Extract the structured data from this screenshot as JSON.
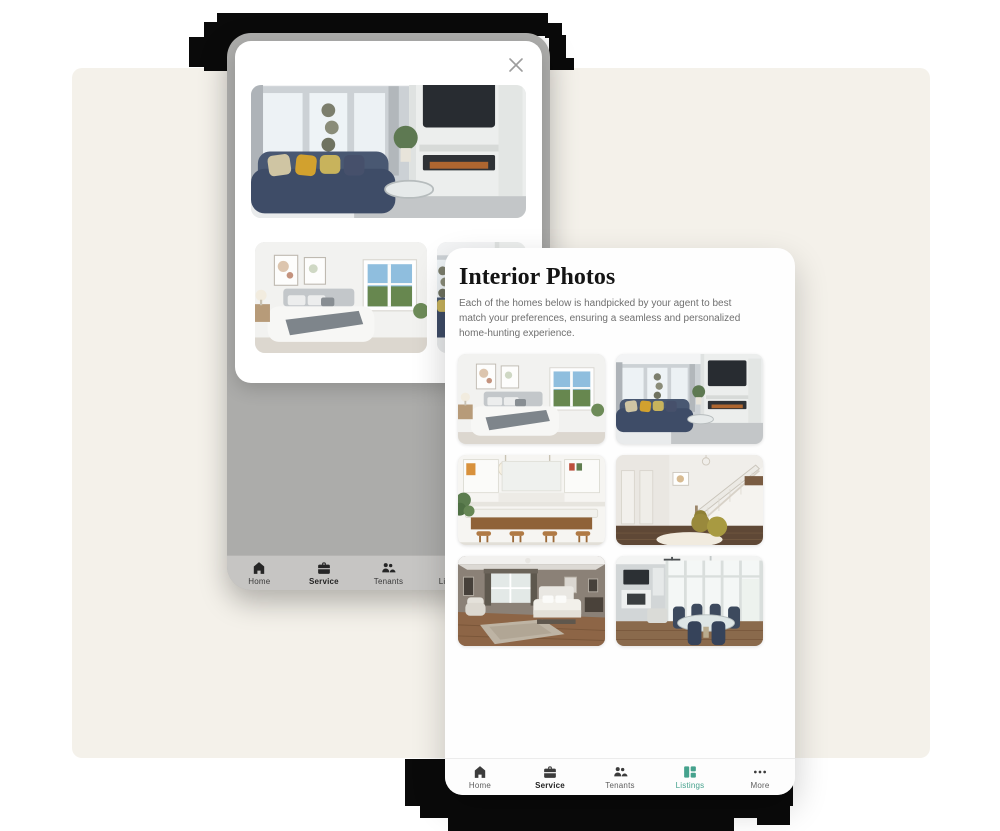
{
  "colors": {
    "canvas_bg": "#f4f1ea",
    "glitch_black": "#0a0a0a",
    "accent_teal": "#45a28d",
    "overlay_gray": "#acacaa"
  },
  "back_phone": {
    "dialog": {
      "close_label": "close",
      "photos": [
        {
          "kind": "living",
          "name": "living-room-photo-large"
        },
        {
          "kind": "bedroom",
          "name": "bedroom-photo-small"
        },
        {
          "kind": "living",
          "name": "partial-photo-small"
        }
      ]
    },
    "nav": {
      "items": [
        {
          "label": "Home",
          "icon": "home-icon",
          "emphasis": false,
          "active": false
        },
        {
          "label": "Service",
          "icon": "service-icon",
          "emphasis": true,
          "active": false
        },
        {
          "label": "Tenants",
          "icon": "tenants-icon",
          "emphasis": false,
          "active": false
        },
        {
          "label": "Listings",
          "icon": "listings-icon",
          "emphasis": false,
          "active": false
        },
        {
          "label": "More",
          "icon": "more-icon",
          "emphasis": false,
          "active": false
        }
      ]
    }
  },
  "front_phone": {
    "title": "Interior Photos",
    "description": "Each of the homes below is handpicked by your agent to best match your preferences, ensuring a seamless and personalized home-hunting experience.",
    "photos": [
      {
        "kind": "bedroom",
        "name": "bedroom-photo"
      },
      {
        "kind": "living",
        "name": "living-room-photo"
      },
      {
        "kind": "kitchen",
        "name": "kitchen-photo"
      },
      {
        "kind": "stairs",
        "name": "staircase-photo"
      },
      {
        "kind": "bedroom2",
        "name": "master-bedroom-photo"
      },
      {
        "kind": "dining",
        "name": "dining-room-photo"
      }
    ],
    "nav": {
      "items": [
        {
          "label": "Home",
          "icon": "home-icon",
          "emphasis": false,
          "active": false
        },
        {
          "label": "Service",
          "icon": "service-icon",
          "emphasis": true,
          "active": false
        },
        {
          "label": "Tenants",
          "icon": "tenants-icon",
          "emphasis": false,
          "active": false
        },
        {
          "label": "Listings",
          "icon": "listings-icon",
          "emphasis": false,
          "active": true
        },
        {
          "label": "More",
          "icon": "more-icon",
          "emphasis": false,
          "active": false
        }
      ]
    }
  }
}
